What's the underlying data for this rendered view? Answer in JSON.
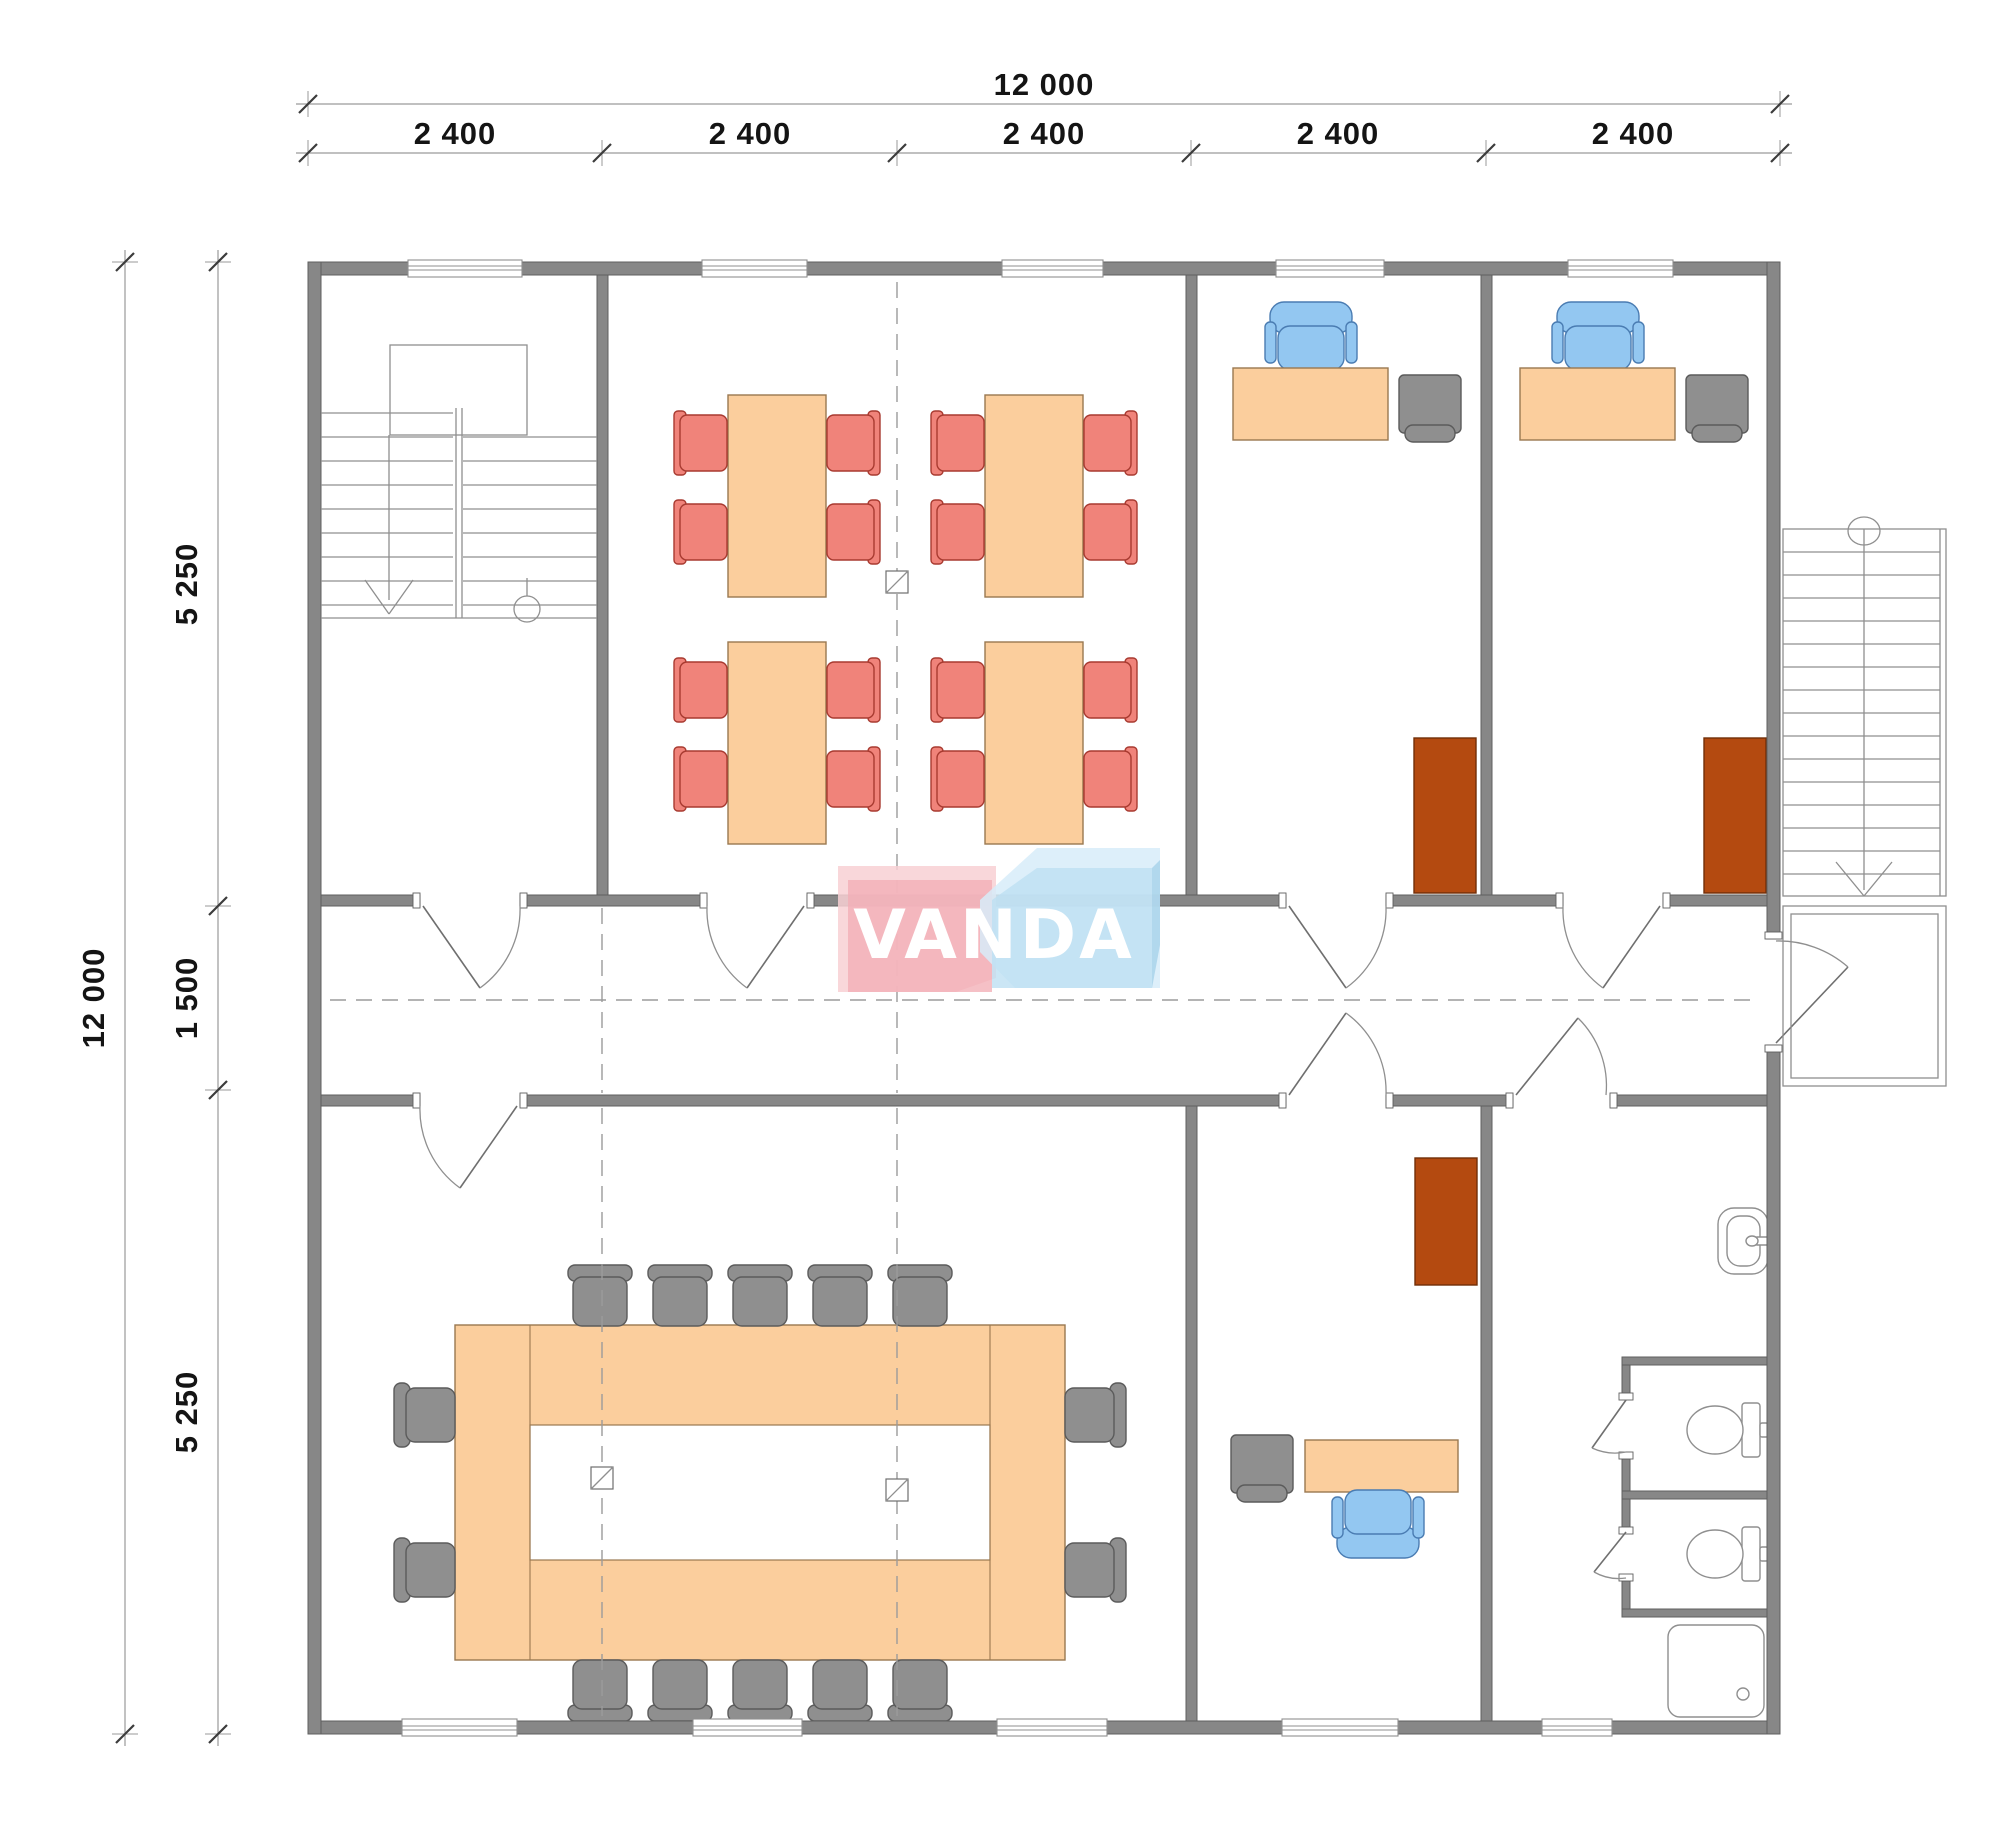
{
  "watermark": {
    "text": "VANDA"
  },
  "dimensions": {
    "top": {
      "total": "12 000",
      "segments": [
        "2 400",
        "2 400",
        "2 400",
        "2 400",
        "2 400"
      ]
    },
    "left": {
      "total": "12 000",
      "segments": [
        "5 250",
        "1 500",
        "5 250"
      ]
    }
  },
  "colors": {
    "paper": "#ffffff",
    "wall": "#878787",
    "wallEdge": "#5f5f5f",
    "line": "#8f8f8f",
    "lineDark": "#6f6f6f",
    "dash": "#9b9b9b",
    "dimLine": "#9a9a9a",
    "dimTick": "#3c3c3c",
    "dimText": "#141414",
    "tableFill": "#fbce9d",
    "tableEdge": "#9a7850",
    "chairRed": "#f0837a",
    "chairRedEdge": "#a83a30",
    "chairBlue": "#93c7f1",
    "chairBlueEdge": "#4a7cb2",
    "grayFurn": "#8f8f8f",
    "grayFurnEdge": "#5b5b5b",
    "wardrobe": "#b44a10",
    "wardrobeEdge": "#712f08",
    "logoPink": "#f2aeb6",
    "logoPinkTop": "#f8d0d4",
    "logoBlue": "#bcdff2",
    "logoBlueTop": "#d7ecf9",
    "logoBlueSide": "#a6d2ea",
    "logoText": "#ffffff"
  }
}
